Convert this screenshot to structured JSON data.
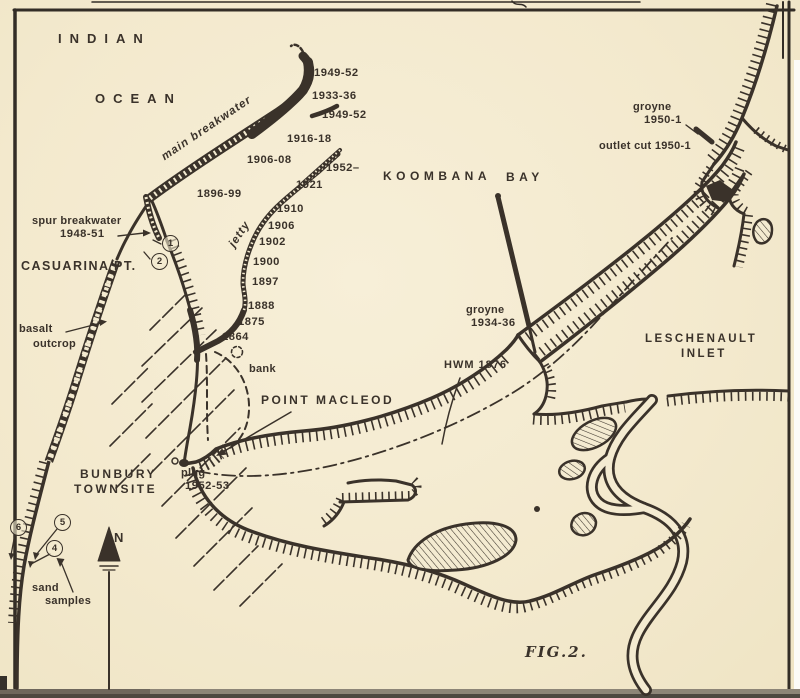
{
  "figure": {
    "caption": "FIG.2."
  },
  "water": {
    "indian1": "INDIAN",
    "indian2": "OCEAN",
    "koombana1": "KOOMBANA",
    "koombana2": "BAY",
    "leschenault1": "LESCHENAULT",
    "leschenault2": "INLET"
  },
  "places": {
    "casuarina": "CASUARINA PT.",
    "macleod": "POINT MACLEOD",
    "bunbury1": "BUNBURY",
    "bunbury2": "TOWNSITE",
    "north": "N"
  },
  "features": {
    "main_breakwater": "main breakwater",
    "jetty": "jetty",
    "spur1": "spur breakwater",
    "spur2": "1948-51",
    "basalt1": "basalt",
    "basalt2": "outcrop",
    "bank": "bank",
    "plug1": "plug",
    "plug2": "1952-53",
    "groyne_cut1": "groyne",
    "groyne_cut2": "1950-1",
    "outlet_cut": "outlet cut 1950-1",
    "groyne_bay1": "groyne",
    "groyne_bay2": "1934-36",
    "hwm": "HWM 1876",
    "sand1": "sand",
    "sand2": "samples"
  },
  "breakwater_dates": [
    "1949-52",
    "1933-36",
    "1949-52",
    "1916-18",
    "1906-08",
    "1896-99"
  ],
  "jetty_dates": [
    "1952–",
    "1921",
    "1910",
    "1906",
    "1902",
    "1900",
    "1897",
    "1888",
    "1875",
    "1864"
  ],
  "markers": {
    "spur": [
      "1",
      "2"
    ],
    "shore": [
      "6",
      "5",
      "4"
    ]
  },
  "colors": {
    "paper": "#f4ebd1",
    "ink": "#3a322a"
  }
}
